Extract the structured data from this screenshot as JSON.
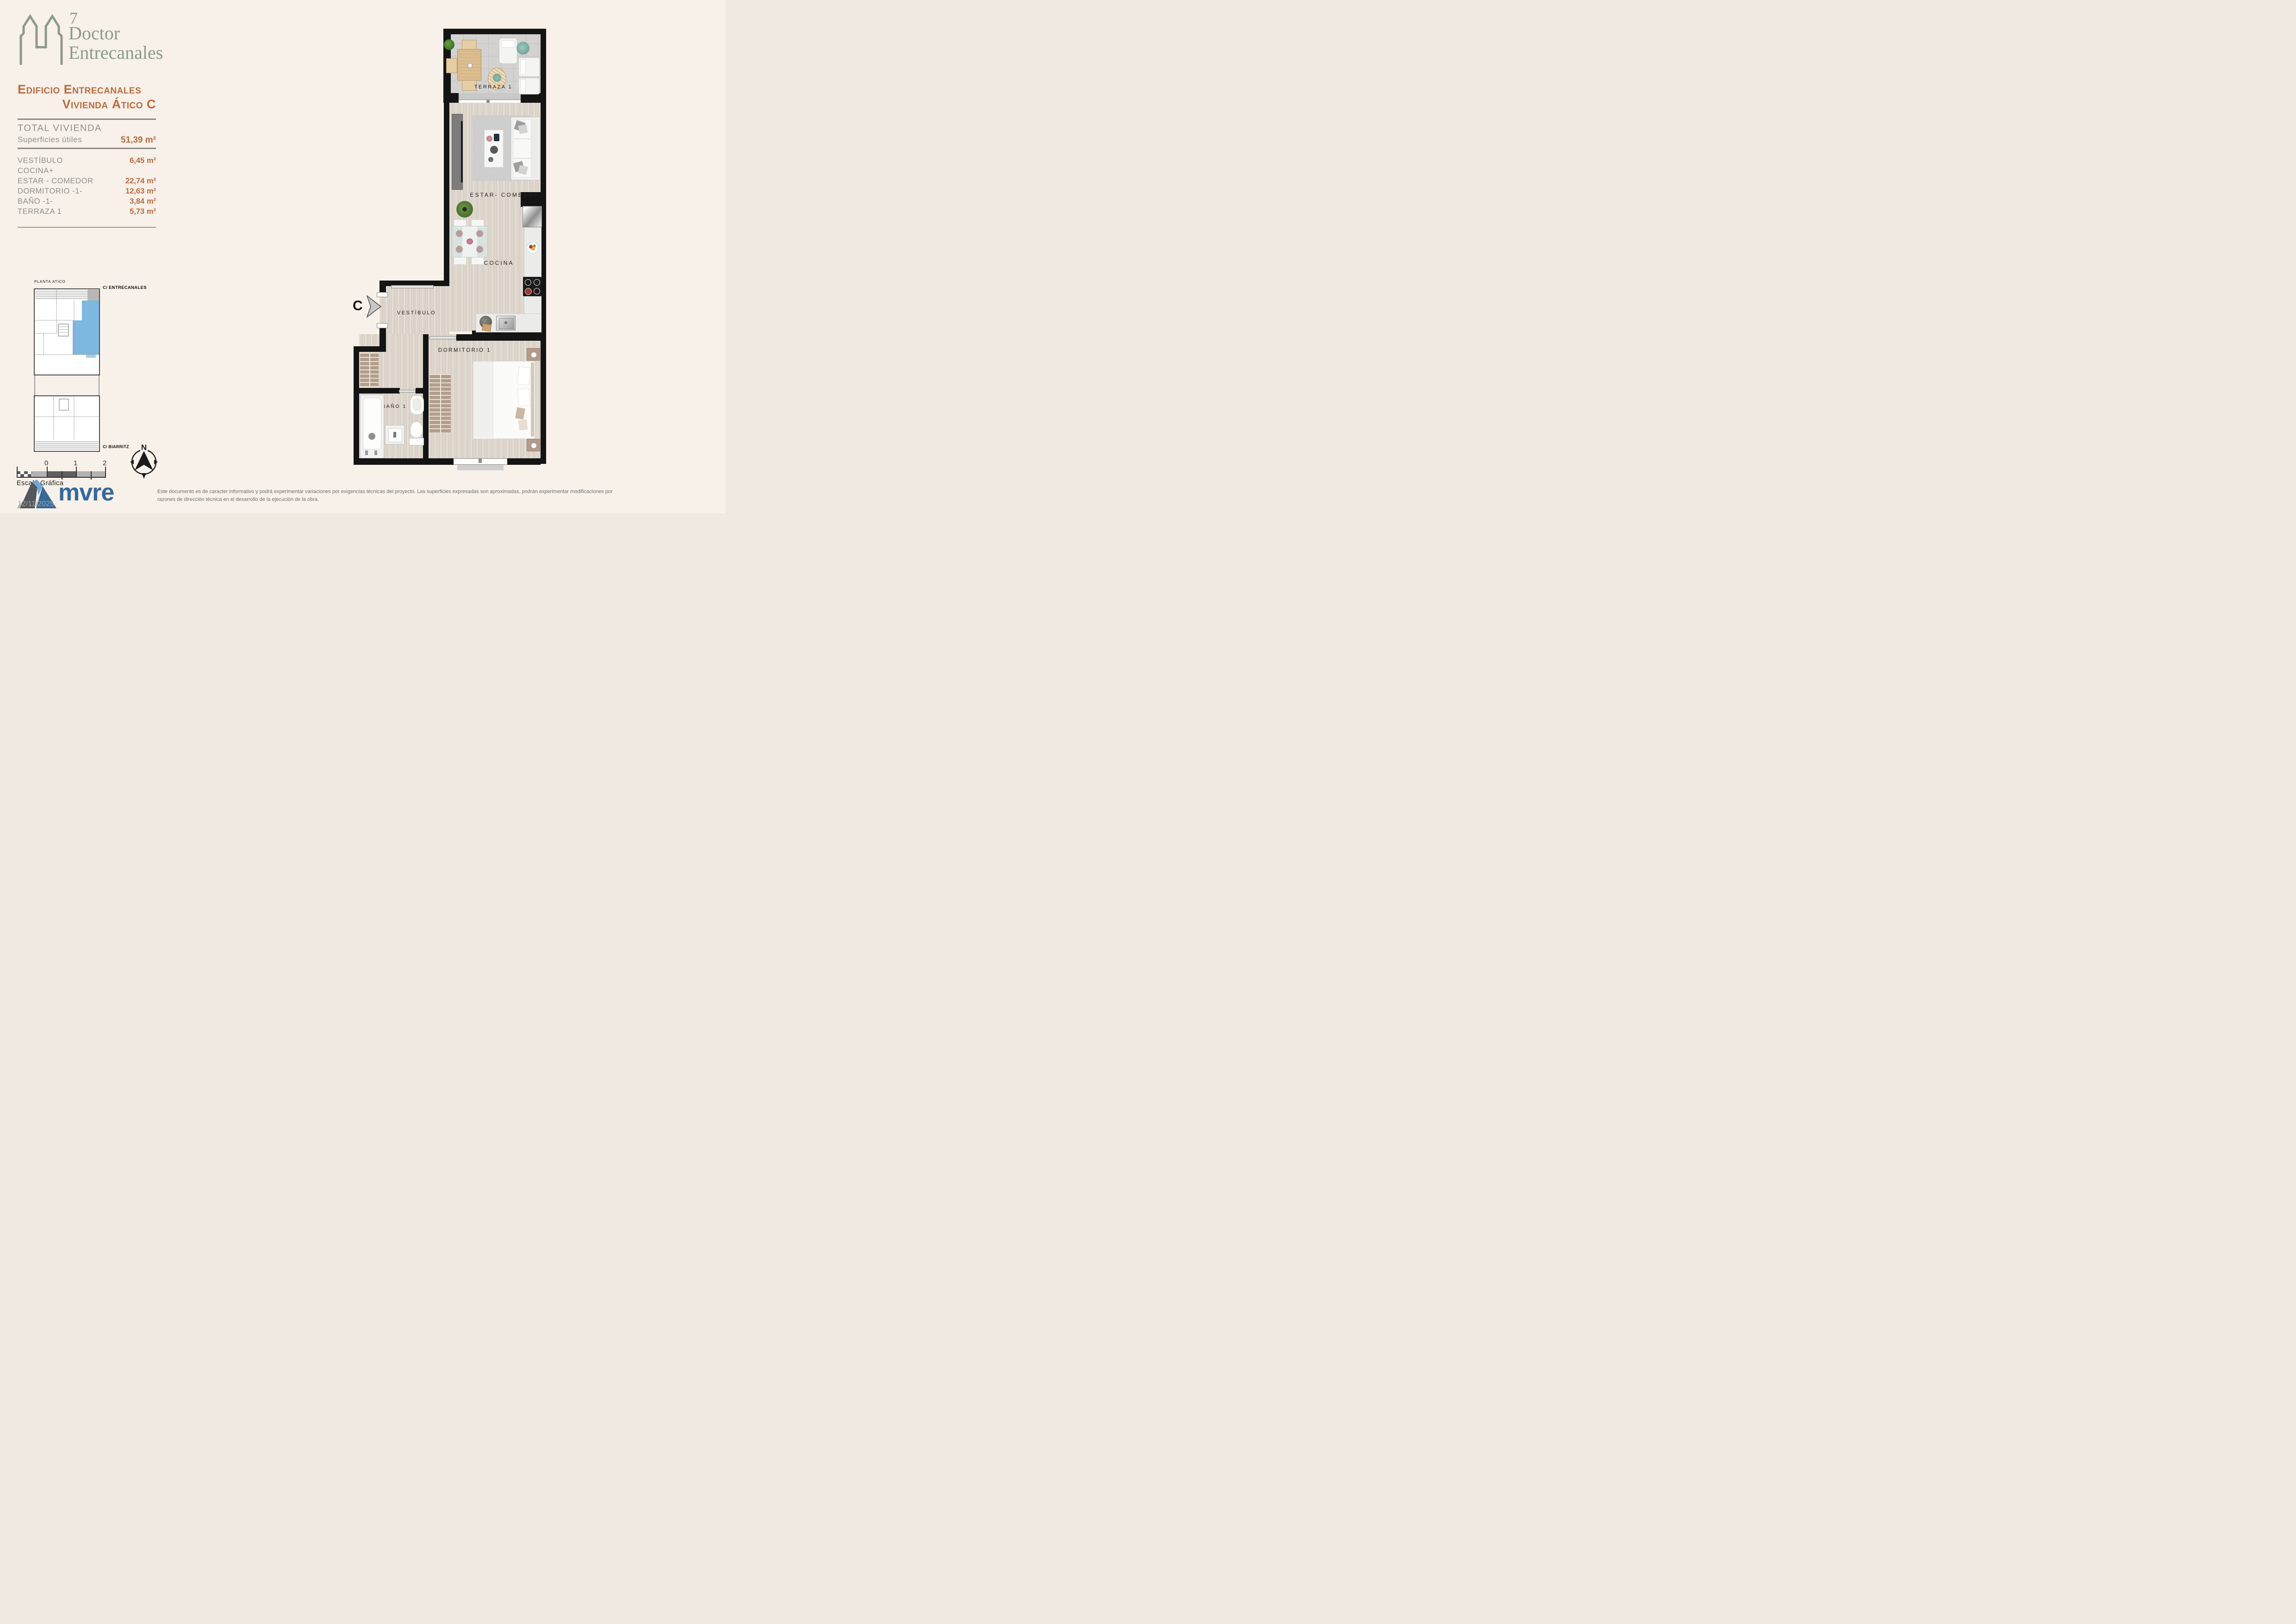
{
  "colors": {
    "background": "#f7f1e9",
    "accent_orange": "#c0693b",
    "logo_sage": "#8b9b8a",
    "brand_blue": "#35689c",
    "keyplan_highlight": "#6fb0dd",
    "wall_black": "#141414"
  },
  "logo": {
    "number": "7",
    "line1": "Doctor",
    "line2": "Entrecanales"
  },
  "header": {
    "title_line1": "Edificio Entrecanales",
    "title_line2": "Vivienda Ático C"
  },
  "summary": {
    "total_label": "TOTAL VIVIENDA",
    "subtotal_label": "Superficies útiles",
    "total_value": "51,39 m²"
  },
  "rooms": [
    {
      "label": "VESTÍBULO",
      "value": "6,45 m²"
    },
    {
      "label": "COCINA+",
      "value": ""
    },
    {
      "label": "ESTAR - COMEDOR",
      "value": "22,74 m²"
    },
    {
      "label": "DORMITORIO -1-",
      "value": "12,63 m²"
    },
    {
      "label": "BAÑO -1-",
      "value": "3,84 m²"
    },
    {
      "label": "TERRAZA 1",
      "value": "5,73 m²"
    }
  ],
  "key_plan": {
    "title": "PLANTA ATICO",
    "street_top": "C/ ENTRECANALES",
    "street_bottom": "C/ BIARRITZ"
  },
  "scale_bar": {
    "label": "Escala Gráfica",
    "ticks": [
      "0",
      "1",
      "2"
    ]
  },
  "compass": {
    "north_label": "N"
  },
  "plan": {
    "entry_label": "C",
    "labels": {
      "terraza": "TERRAZA 1",
      "estar": "ESTAR- COMEDOR",
      "cocina": "COCINA",
      "vestibulo": "VESTÍBULO",
      "dormitorio": "DORMITORIO 1",
      "bano": "BAÑO 1"
    }
  },
  "footer": {
    "brand": "mvre",
    "date": "12/11/2025",
    "disclaimer_line1": "Este documento es de caracter informativo y podrá experimentar variaciones por exigencias técnicas del proyecto. Las superficies expresadas son aproximadas, podrán experimentar modificaciones por",
    "disclaimer_line2": "razones de dirección técnica en el desarrollo de la ejecución de la obra."
  }
}
